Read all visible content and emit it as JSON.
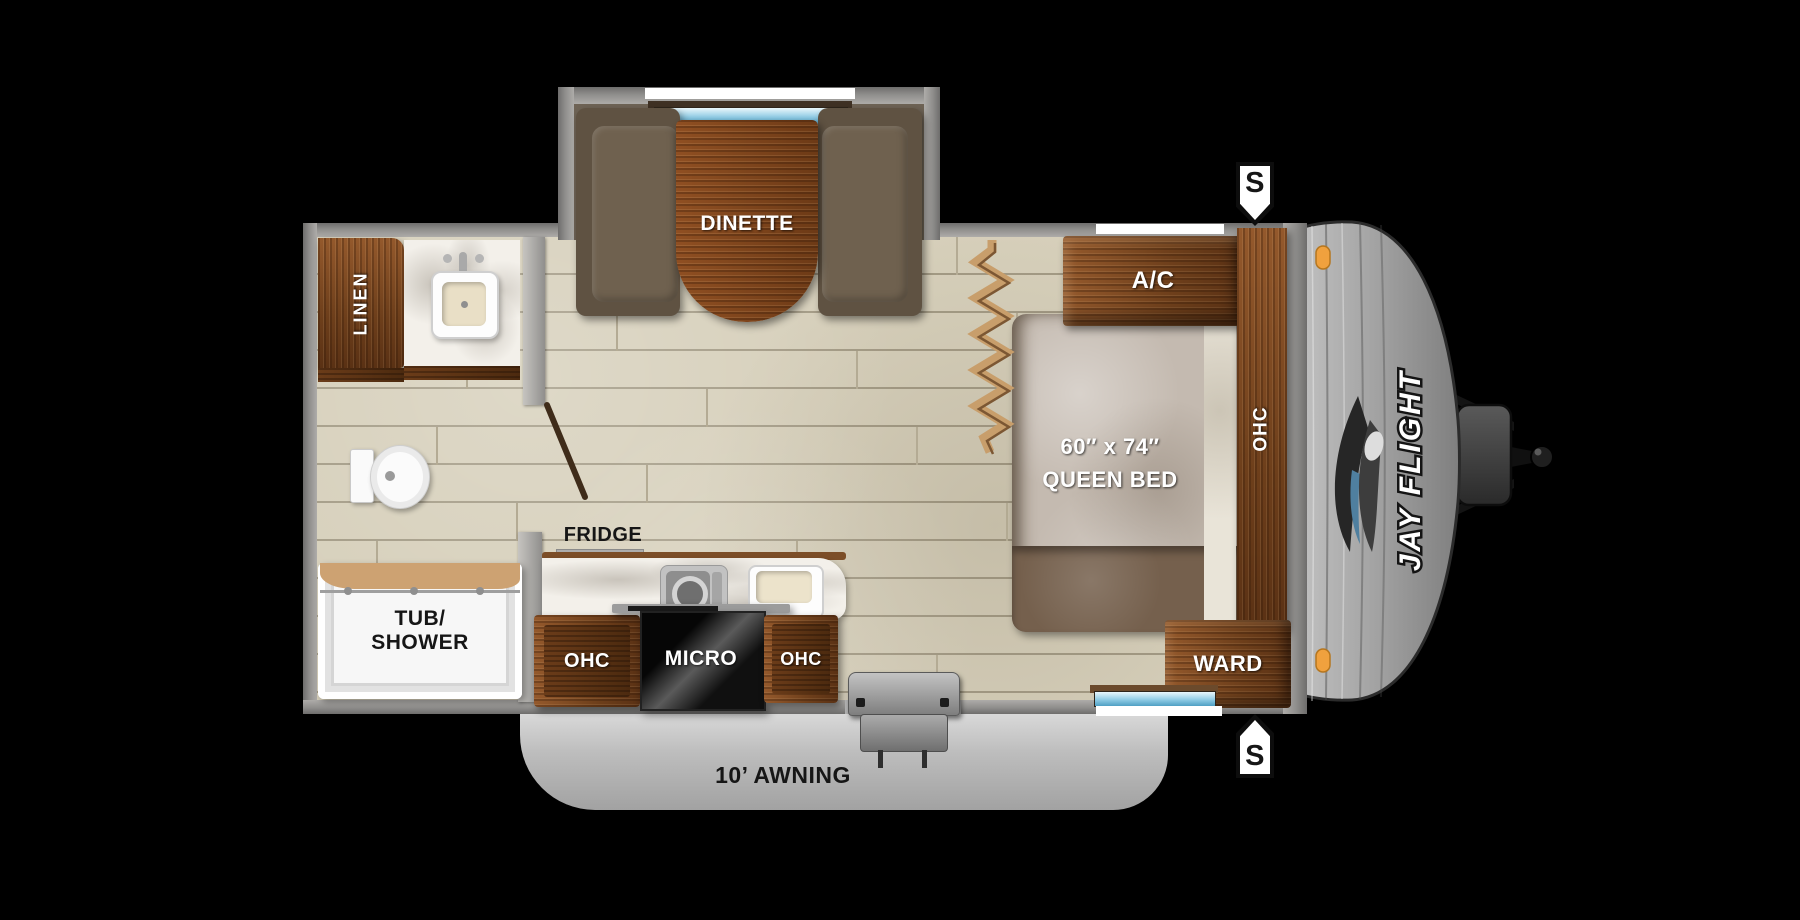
{
  "labels": {
    "dinette": "DINETTE",
    "linen": "LINEN",
    "tub_line1": "TUB/",
    "tub_line2": "SHOWER",
    "fridge": "FRIDGE",
    "kitchen_ohc_left": "OHC",
    "kitchen_micro": "MICRO",
    "kitchen_ohc_right": "OHC",
    "bed_size": "60″ x 74″",
    "bed_type": "QUEEN BED",
    "ac": "A/C",
    "bedroom_ohc": "OHC",
    "ward": "WARD",
    "speaker_top": "S",
    "speaker_bottom": "S",
    "awning": "10’ AWNING",
    "brand": "JAY FLIGHT"
  },
  "colors": {
    "background": "#000000",
    "wall_gray": "#8f8e8c",
    "floor_beige": "#d6cfba",
    "cabinet_wood": "#7a4a26",
    "window_blue": "#7cc0de",
    "marker_orange": "#f0a13e",
    "awning_gray": "#c9c9c9",
    "micro_black": "#111111",
    "fixture_white": "#f7f7f7"
  }
}
